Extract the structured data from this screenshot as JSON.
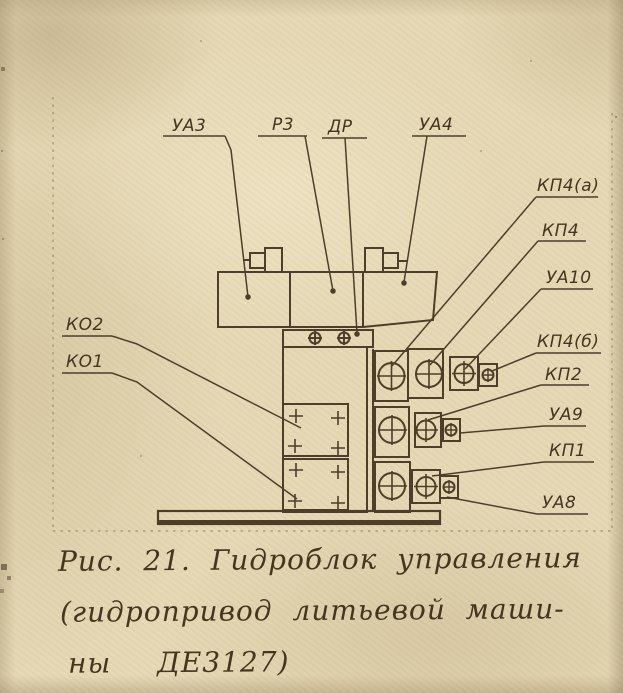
{
  "figure": {
    "callouts": [
      {
        "id": "ua3",
        "text": "УА3"
      },
      {
        "id": "r3",
        "text": "Р3"
      },
      {
        "id": "dr",
        "text": "ДР"
      },
      {
        "id": "ua4",
        "text": "УА4"
      },
      {
        "id": "kp4a",
        "text": "КП4(а)"
      },
      {
        "id": "kp4",
        "text": "КП4"
      },
      {
        "id": "ua10",
        "text": "УА10"
      },
      {
        "id": "kp4b",
        "text": "КП4(б)"
      },
      {
        "id": "kp2",
        "text": "КП2"
      },
      {
        "id": "ua9",
        "text": "УА9"
      },
      {
        "id": "kp1",
        "text": "КП1"
      },
      {
        "id": "ua8",
        "text": "УА8"
      },
      {
        "id": "ko2",
        "text": "КО2"
      },
      {
        "id": "ko1",
        "text": "КО1"
      }
    ],
    "caption": {
      "line1": "Рис. 21. Гидроблок управления",
      "line2": "(гидропривод литьевой маши-",
      "line3": "ны ДЕ3127)"
    },
    "colors": {
      "paper": "#e7d9b6",
      "ink": "#4f3e29"
    }
  }
}
